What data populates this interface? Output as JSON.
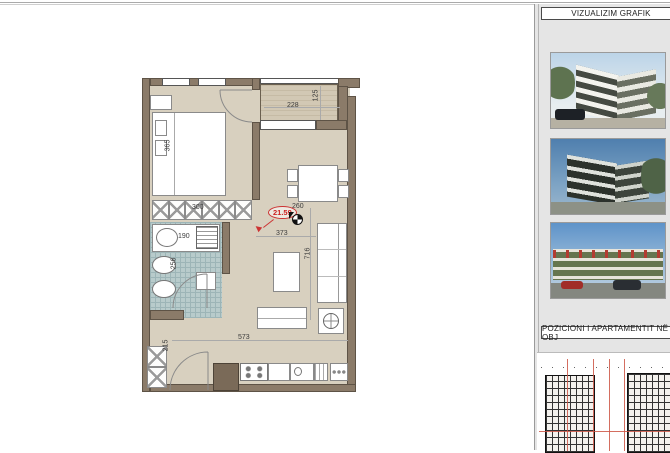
{
  "sidebar": {
    "header_visualization": "VIZUALIZIM GRAFIK",
    "header_position": "POZICIONI I APARTAMENTIT NË OBJ",
    "render_names": [
      "render-building-corner",
      "render-building-street",
      "render-building-facade"
    ]
  },
  "plan": {
    "area_label": "21.59",
    "dimensions": {
      "balcony_width": "228",
      "balcony_depth": "125",
      "bedroom_length": "365",
      "wardrobe_width": "300",
      "bathroom_width": "190",
      "bathroom_length": "256",
      "dining_width": "260",
      "hall_width": "373",
      "living_length": "716",
      "living_width": "573",
      "entry_length": "215"
    }
  },
  "colors": {
    "wall": "#8b7b69",
    "floor": "#d8d0bf",
    "balcony_floor": "#d2c8b4",
    "bath_tile": "#b8cbcb",
    "accent_red": "#cc3333",
    "sidebar_bg": "#e5e5e5",
    "sky": "#bcd4e8"
  }
}
